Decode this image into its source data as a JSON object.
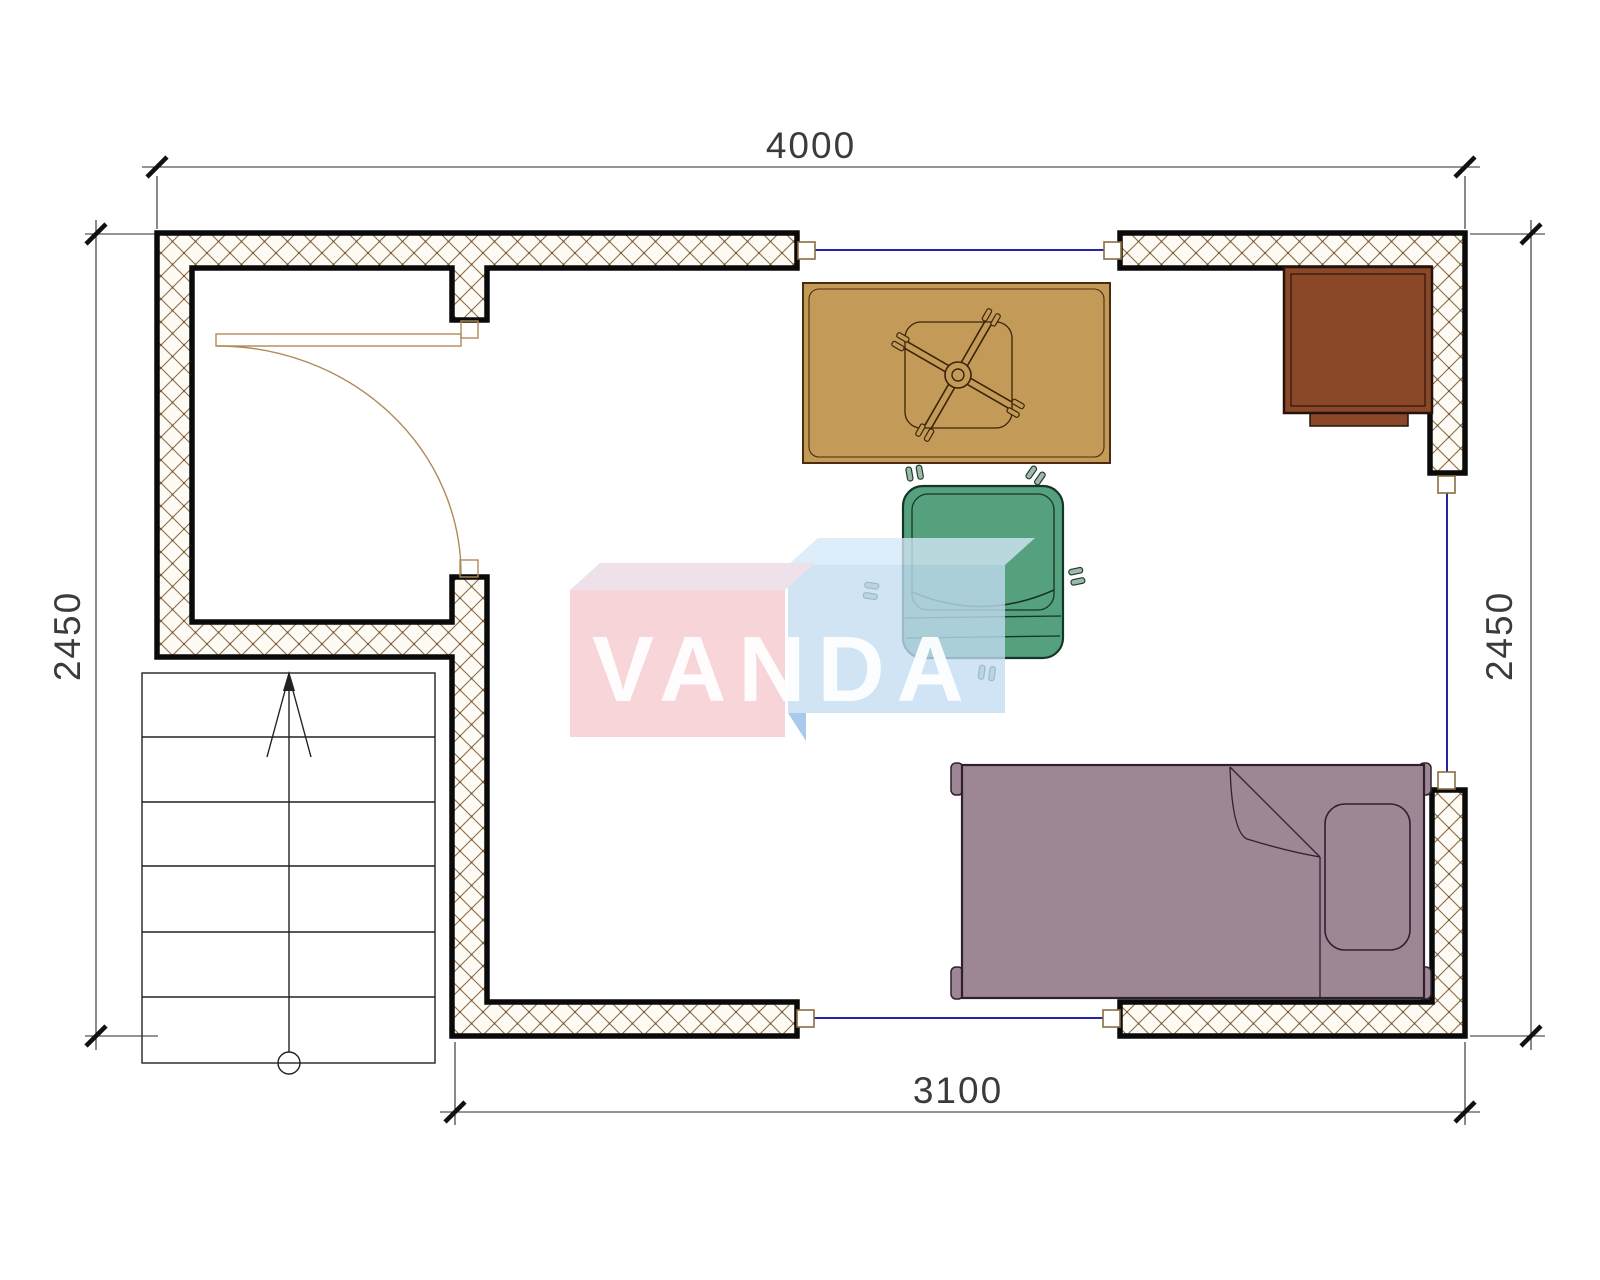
{
  "drawing": {
    "type": "floor-plan",
    "watermark": {
      "text": "VANDA"
    },
    "dimensions": {
      "top": {
        "label": "4000",
        "orientation": "horizontal"
      },
      "bottom": {
        "label": "3100",
        "orientation": "horizontal"
      },
      "left": {
        "label": "2450",
        "orientation": "vertical"
      },
      "right": {
        "label": "2450",
        "orientation": "vertical"
      }
    },
    "elements": {
      "walls": "hatched-masonry-walls",
      "door": "swing-door-top-left",
      "stairs": {
        "name": "staircase",
        "treads": 6,
        "direction_arrow": "up"
      },
      "windows": "blue-line-openings-top-right-bottom",
      "furniture": [
        {
          "name": "desk-with-chair-base",
          "color": "#c49a58"
        },
        {
          "name": "cabinet",
          "color": "#8b4829"
        },
        {
          "name": "office-chair",
          "color": "#55a17e"
        },
        {
          "name": "single-bed-with-pillow",
          "color": "#9d8795"
        }
      ]
    },
    "colors": {
      "wall_hatch": "#8a6d4a",
      "wall_outline": "#0a0a0a",
      "window_line": "#2525a8",
      "door": "#b08a56",
      "watermark_pink": "#f5c9cd",
      "watermark_blue": "#c3ddf2",
      "dimension_text": "#3b3b3b"
    }
  }
}
